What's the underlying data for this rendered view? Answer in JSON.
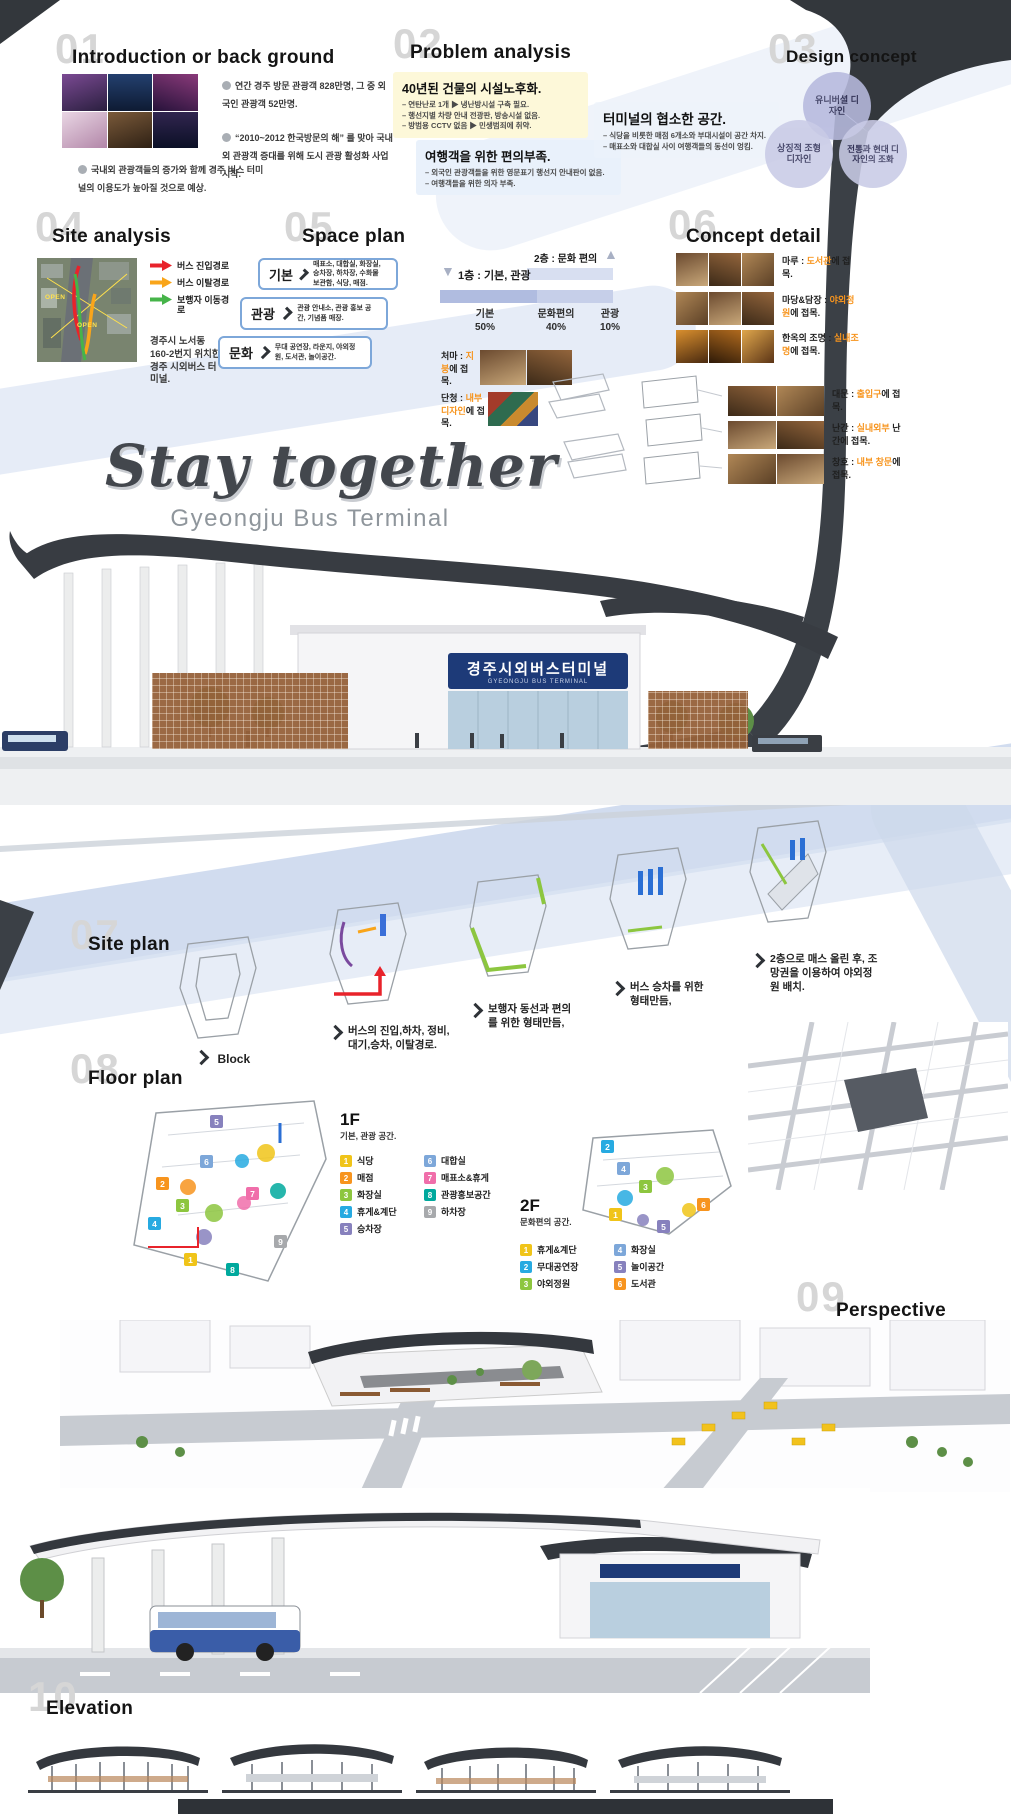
{
  "poster": {
    "title": "Stay together",
    "subtitle": "Gyeongju Bus Terminal"
  },
  "building_sign": {
    "kr": "경주시외버스터미널",
    "en": "GYEONGJU BUS TERMINAL"
  },
  "sections": {
    "intro": {
      "number": "01",
      "title": "Introduction or back ground",
      "notes": [
        "연간 경주 방문 관광객 828만명, 그 중 외국인 관광객 52만명.",
        "“2010~2012 한국방문의 해” 를 맞아 국내외 관광객 증대를 위해 도시 관광 활성화 사업 시작.",
        "국내외 관광객들의 증가와 함께 경주 버스 터미널의 이용도가 높아질 것으로 예상."
      ]
    },
    "problem": {
      "number": "02",
      "title": "Problem analysis",
      "boxes": [
        {
          "heading": "40년된 건물의 시설노후화.",
          "items": [
            "– 연탄난로 1개 ▶ 냉난방시설 구축 필요.",
            "– 행선지별 차량 안내 전광판, 방송시설 없음.",
            "– 방범용 CCTV 없음 ▶ 민생범죄에 취약."
          ]
        },
        {
          "heading": "여행객을 위한 편의부족.",
          "items": [
            "– 외국인 관광객들을 위한 영문표기 행선지 안내판이 없음.",
            "– 여행객들을 위한 의자 부족."
          ]
        },
        {
          "heading": "터미널의 협소한 공간.",
          "items": [
            "– 식당을 비롯한 매점 6개소와 부대시설이 공간 차지.",
            "– 매표소와 대합실 사이 여행객들의 동선이 엉킴."
          ]
        }
      ]
    },
    "design_concept": {
      "number": "03",
      "title": "Design concept",
      "circles": [
        "유니버셜 디자인",
        "상징적 조형 디자인",
        "전통과 현대 디자인의 조화"
      ]
    },
    "site_analysis": {
      "number": "04",
      "title": "Site analysis",
      "legend": [
        {
          "label": "버스 진입경로",
          "color": "#e8232b"
        },
        {
          "label": "버스 이탈경로",
          "color": "#f9a51a"
        },
        {
          "label": "보행자 이동경로",
          "color": "#46b449"
        }
      ],
      "map_label": "OPEN",
      "address": "경주시 노서동 160-2번지 위치한 경주 시외버스 터미널."
    },
    "space_plan": {
      "number": "05",
      "title": "Space plan",
      "rows": [
        {
          "label": "기본",
          "detail": "매표소, 대합실, 화장실, 승차장, 하차장, 수화물 보관함, 식당, 매점."
        },
        {
          "label": "관광",
          "detail": "관광 안내소, 관광 홍보 공간, 기념품 매장."
        },
        {
          "label": "문화",
          "detail": "무대 공연장, 라운지, 야외정원, 도서관, 놀이공간."
        }
      ],
      "floor2_label": "2층 : 문화 편의",
      "floor1_label": "1층 : 기본, 관광",
      "chart": {
        "segments": [
          {
            "name": "기본",
            "pct": "50%"
          },
          {
            "name": "문화편의",
            "pct": "40%"
          },
          {
            "name": "관광",
            "pct": "10%"
          }
        ]
      },
      "adapt": [
        {
          "name": "처마 :",
          "highlight": "지붕",
          "tail": "에 접목."
        },
        {
          "name": "단청 :",
          "highlight": "내부디자인",
          "tail": "에 접목."
        }
      ]
    },
    "concept_detail": {
      "number": "06",
      "title": "Concept detail",
      "items": [
        {
          "name": "마루",
          "sep": " : ",
          "highlight": "도서관",
          "tail": "에 접목."
        },
        {
          "name": "마당&담장",
          "sep": " : ",
          "highlight": "야외정원",
          "tail": "에 접목."
        },
        {
          "name": "한옥의 조명",
          "sep": " : ",
          "highlight": "실내조명",
          "tail": "에 접목."
        },
        {
          "name": "대문",
          "sep": " : ",
          "highlight": "출입구",
          "tail": "에 접목."
        },
        {
          "name": "난간",
          "sep": " : ",
          "highlight": "실내외부",
          "tail": " 난간에 접목."
        },
        {
          "name": "창호",
          "sep": " : ",
          "highlight": "내부 창문",
          "tail": "에 접목."
        }
      ]
    },
    "site_plan": {
      "number": "07",
      "title": "Site plan",
      "steps": [
        {
          "caption": "Block"
        },
        {
          "caption": "버스의 진입,하차, 정비,대기,승차, 이탈경로."
        },
        {
          "caption": "보행자 동선과 편의를 위한 형태만듬,"
        },
        {
          "caption": "버스 승차를 위한 형태만듬,"
        },
        {
          "caption": "2층으로 매스 올린 후, 조망권을 이용하여 야외정원 배치."
        }
      ]
    },
    "floor_plan": {
      "number": "08",
      "title": "Floor plan",
      "f1": {
        "label": "1F",
        "subtitle": "기본, 관광 공간.",
        "legend": [
          {
            "n": "1",
            "name": "식당",
            "color": "#f0c419"
          },
          {
            "n": "2",
            "name": "매점",
            "color": "#f7941e"
          },
          {
            "n": "3",
            "name": "화장실",
            "color": "#8dc63f"
          },
          {
            "n": "4",
            "name": "휴게&계단",
            "color": "#27aae1"
          },
          {
            "n": "5",
            "name": "승차장",
            "color": "#8781bd"
          },
          {
            "n": "6",
            "name": "대합실",
            "color": "#7da7d9"
          },
          {
            "n": "7",
            "name": "매표소&휴게",
            "color": "#f06eaa"
          },
          {
            "n": "8",
            "name": "관광홍보공간",
            "color": "#00a99d"
          },
          {
            "n": "9",
            "name": "하차장",
            "color": "#a7a9ac"
          }
        ]
      },
      "f2": {
        "label": "2F",
        "subtitle": "문화편의 공간.",
        "legend": [
          {
            "n": "1",
            "name": "휴게&계단",
            "color": "#f0c419"
          },
          {
            "n": "2",
            "name": "무대공연장",
            "color": "#27aae1"
          },
          {
            "n": "3",
            "name": "야외정원",
            "color": "#8dc63f"
          },
          {
            "n": "4",
            "name": "화장실",
            "color": "#7da7d9"
          },
          {
            "n": "5",
            "name": "놀이공간",
            "color": "#8781bd"
          },
          {
            "n": "6",
            "name": "도서관",
            "color": "#f7941e"
          }
        ]
      }
    },
    "perspective": {
      "number": "09",
      "title": "Perspective"
    },
    "elevation": {
      "number": "10",
      "title": "Elevation"
    }
  },
  "chart_data": {
    "type": "bar",
    "stacked": true,
    "categories": [
      "기본",
      "문화편의",
      "관광"
    ],
    "values": [
      50,
      40,
      10
    ],
    "unit": "%",
    "floor_notes": [
      "1층 : 기본, 관광",
      "2층 : 문화 편의"
    ],
    "grid": false,
    "legend_position": "below"
  }
}
